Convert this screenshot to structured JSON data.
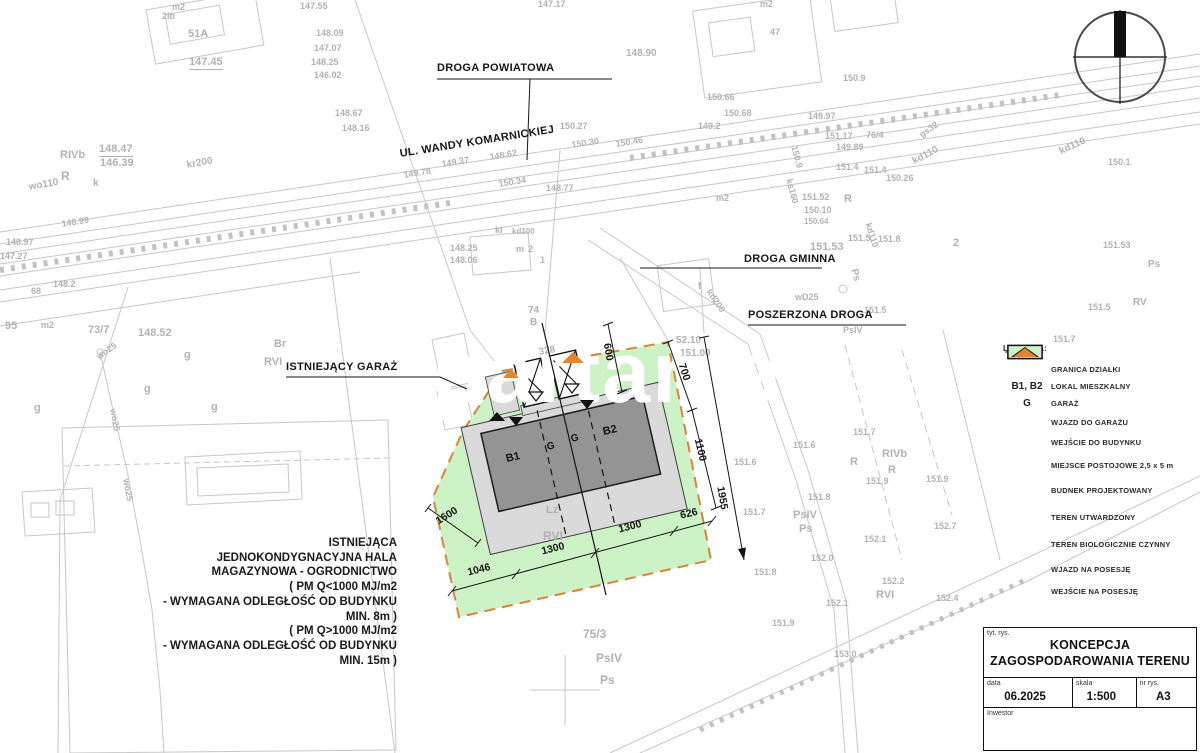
{
  "watermark": "apartame",
  "colors": {
    "green": "#cdf2c5",
    "dark": "#949494",
    "light": "#dadada",
    "orange": "#e2862e",
    "boundary": "#d9833b"
  },
  "callouts": {
    "droga_powiatowa": "DROGA POWIATOWA",
    "ul_wandy": "UL. WANDY KOMARNICKIEJ",
    "droga_gminna": "DROGA GMINNA",
    "poszerzona_droga": "POSZERZONA DROGA",
    "istniejacy_garaz": "ISTNIEJĄCY GARAŻ"
  },
  "note": {
    "lines": [
      "ISTNIEJĄCA",
      "JEDNOKONDYGNACYJNA HALA",
      "MAGAZYNOWA - OGRODNICTWO",
      "( PM Q<1000 MJ/m2",
      "- WYMAGANA ODLEGŁOŚĆ OD BUDYNKU",
      "MIN. 8m )",
      "( PM Q>1000 MJ/m2",
      "- WYMAGANA ODLEGŁOŚĆ OD BUDYNKU",
      "MIN. 15m )"
    ]
  },
  "dims": [
    {
      "t": "600",
      "x": 608,
      "y": 352,
      "r": 80
    },
    {
      "t": "700",
      "x": 684,
      "y": 372,
      "r": 72
    },
    {
      "t": "1100",
      "x": 700,
      "y": 450,
      "r": 77
    },
    {
      "t": "1955",
      "x": 722,
      "y": 498,
      "r": 80
    },
    {
      "t": "1600",
      "x": 447,
      "y": 516,
      "r": -32
    },
    {
      "t": "1046",
      "x": 479,
      "y": 570,
      "r": -14
    },
    {
      "t": "1300",
      "x": 553,
      "y": 549,
      "r": -14
    },
    {
      "t": "1300",
      "x": 630,
      "y": 527,
      "r": -14
    },
    {
      "t": "626",
      "x": 689,
      "y": 514,
      "r": -14
    }
  ],
  "building_labels": [
    {
      "t": "B1",
      "x": 513,
      "y": 458,
      "r": -13,
      "fs": 11
    },
    {
      "t": "G",
      "x": 551,
      "y": 447,
      "r": -13,
      "fs": 10
    },
    {
      "t": "G",
      "x": 575,
      "y": 439,
      "r": -13,
      "fs": 10
    },
    {
      "t": "B2",
      "x": 610,
      "y": 431,
      "r": -13,
      "fs": 11
    }
  ],
  "map_text": [
    [
      300,
      2,
      "147.55"
    ],
    [
      316,
      29,
      "148.09"
    ],
    [
      314,
      44,
      "147.07"
    ],
    [
      311,
      58,
      "148.25"
    ],
    [
      314,
      71,
      "146.02"
    ],
    [
      335,
      109,
      "148.67"
    ],
    [
      342,
      124,
      "148.16"
    ],
    [
      172,
      3,
      "m2"
    ],
    [
      162,
      12,
      "2lb"
    ],
    [
      188,
      29,
      "51A",
      0,
      11
    ],
    [
      189,
      57,
      "147.45",
      0,
      11,
      1
    ],
    [
      538,
      0,
      "147.17"
    ],
    [
      626,
      49,
      "148.90",
      0,
      10
    ],
    [
      60,
      150,
      "RIVb",
      0,
      11
    ],
    [
      99,
      144,
      "148.47",
      0,
      11,
      1
    ],
    [
      100,
      158,
      "146.39",
      0,
      11
    ],
    [
      61,
      170,
      "R",
      0,
      12
    ],
    [
      93,
      179,
      "k",
      0,
      10
    ],
    [
      28,
      183,
      "wo110",
      -10,
      10
    ],
    [
      186,
      161,
      "kr200",
      -10,
      10
    ],
    [
      403,
      171,
      "149.78",
      -9
    ],
    [
      441,
      160,
      "149.37",
      -9
    ],
    [
      489,
      153,
      "148.62",
      -9
    ],
    [
      498,
      180,
      "150.34",
      -9
    ],
    [
      546,
      184,
      "148.77"
    ],
    [
      560,
      122,
      "150.27"
    ],
    [
      571,
      141,
      "150.30",
      -9
    ],
    [
      615,
      140,
      "150.46",
      -9
    ],
    [
      495,
      226,
      "kl"
    ],
    [
      512,
      228,
      "kd100",
      0,
      8
    ],
    [
      516,
      245,
      "m"
    ],
    [
      528,
      245,
      "2"
    ],
    [
      540,
      256,
      "1"
    ],
    [
      450,
      244,
      "148.25"
    ],
    [
      450,
      256,
      "148.06"
    ],
    [
      528,
      306,
      "74",
      0,
      10
    ],
    [
      530,
      318,
      "B",
      0,
      10
    ],
    [
      716,
      194,
      "m2"
    ],
    [
      770,
      28,
      "47"
    ],
    [
      760,
      0,
      "m2"
    ],
    [
      843,
      74,
      "150.9"
    ],
    [
      707,
      93,
      "150.66"
    ],
    [
      724,
      109,
      "150.68"
    ],
    [
      698,
      122,
      "149.2"
    ],
    [
      808,
      112,
      "149.97"
    ],
    [
      825,
      132,
      "151.17"
    ],
    [
      866,
      131,
      "76/4"
    ],
    [
      836,
      143,
      "149.89"
    ],
    [
      798,
      145,
      "150.9",
      75
    ],
    [
      836,
      163,
      "151.4"
    ],
    [
      864,
      166,
      "151.4"
    ],
    [
      886,
      174,
      "150.26"
    ],
    [
      911,
      158,
      "kd110",
      -28,
      10
    ],
    [
      918,
      132,
      "gs32",
      -35
    ],
    [
      872,
      222,
      "kd110",
      72
    ],
    [
      793,
      178,
      "ks160",
      75
    ],
    [
      802,
      193,
      "151.52"
    ],
    [
      844,
      194,
      "R",
      0,
      11
    ],
    [
      804,
      206,
      "150.10"
    ],
    [
      804,
      218,
      "150.64",
      0,
      8
    ],
    [
      848,
      234,
      "151.5"
    ],
    [
      810,
      242,
      "151.53",
      0,
      11
    ],
    [
      878,
      235,
      "151.8"
    ],
    [
      953,
      238,
      "2",
      0,
      11
    ],
    [
      858,
      268,
      "Ps",
      75,
      10
    ],
    [
      795,
      293,
      "wD25",
      0,
      9
    ],
    [
      843,
      326,
      "PsIV"
    ],
    [
      864,
      306,
      "151.5"
    ],
    [
      698,
      281,
      "t",
      0,
      11
    ],
    [
      712,
      288,
      "kd200",
      55,
      9
    ],
    [
      88,
      325,
      "73/7",
      0,
      11
    ],
    [
      274,
      339,
      "Br",
      0,
      11
    ],
    [
      264,
      357,
      "RVI",
      0,
      11
    ],
    [
      41,
      321,
      "m2"
    ],
    [
      138,
      328,
      "148.52",
      0,
      11
    ],
    [
      5,
      321,
      "95",
      0,
      11
    ],
    [
      184,
      350,
      "g",
      0,
      11
    ],
    [
      144,
      384,
      "g",
      0,
      11
    ],
    [
      211,
      402,
      "g",
      0,
      11
    ],
    [
      34,
      403,
      "g",
      0,
      11
    ],
    [
      95,
      354,
      "wo25",
      -35,
      9
    ],
    [
      117,
      408,
      "wo25",
      80,
      9
    ],
    [
      130,
      478,
      "wo25",
      80,
      9
    ],
    [
      61,
      220,
      "148.99",
      -9
    ],
    [
      6,
      238,
      "148.97"
    ],
    [
      0,
      252,
      "147.27"
    ],
    [
      53,
      280,
      "148.2"
    ],
    [
      31,
      287,
      "68"
    ],
    [
      538,
      348,
      "328",
      -10,
      10
    ],
    [
      676,
      336,
      "52.10",
      0,
      10
    ],
    [
      680,
      349,
      "151.00",
      0,
      10
    ],
    [
      546,
      505,
      "Lz",
      0,
      11
    ],
    [
      543,
      530,
      "RVI",
      0,
      12
    ],
    [
      583,
      628,
      "75/3",
      0,
      12
    ],
    [
      596,
      652,
      "PsIV",
      0,
      12
    ],
    [
      600,
      674,
      "Ps",
      0,
      12
    ],
    [
      793,
      441,
      "151.6"
    ],
    [
      853,
      428,
      "151.7"
    ],
    [
      734,
      458,
      "151.6"
    ],
    [
      808,
      493,
      "151.8"
    ],
    [
      793,
      510,
      "PsIV",
      0,
      11
    ],
    [
      799,
      524,
      "Ps",
      0,
      11
    ],
    [
      743,
      508,
      "151.7"
    ],
    [
      850,
      457,
      "R",
      0,
      11
    ],
    [
      882,
      449,
      "RIVb",
      0,
      11
    ],
    [
      888,
      465,
      "R",
      0,
      11
    ],
    [
      866,
      477,
      "151.9"
    ],
    [
      926,
      475,
      "151.9"
    ],
    [
      864,
      535,
      "152.1"
    ],
    [
      811,
      554,
      "152.0"
    ],
    [
      882,
      577,
      "152.2"
    ],
    [
      876,
      590,
      "RVI",
      0,
      11
    ],
    [
      754,
      568,
      "151.8"
    ],
    [
      826,
      599,
      "152.1"
    ],
    [
      772,
      619,
      "151.9"
    ],
    [
      934,
      522,
      "152.7"
    ],
    [
      936,
      594,
      "152.4"
    ],
    [
      834,
      650,
      "153.0"
    ],
    [
      1058,
      148,
      "kd110",
      -25,
      10
    ],
    [
      1108,
      158,
      "150.1"
    ],
    [
      1103,
      241,
      "151.53"
    ],
    [
      1148,
      260,
      "Ps",
      0,
      10
    ],
    [
      1088,
      303,
      "151.5"
    ],
    [
      1133,
      298,
      "RV",
      0,
      10
    ],
    [
      1053,
      335,
      "151.7"
    ]
  ],
  "legend": {
    "title": "LEGENDA:",
    "items": [
      {
        "sym": "dash-orange",
        "label": "GRANICA DZIAŁKI",
        "h": 18
      },
      {
        "sym": "text",
        "symtext": "B1, B2",
        "label": "LOKAL MIESZKALNY",
        "h": 17
      },
      {
        "sym": "text",
        "symtext": "G",
        "label": "GARAŻ",
        "h": 17
      },
      {
        "sym": "tri-down-white",
        "label": "WJAZD DO GARAŻU",
        "h": 20
      },
      {
        "sym": "tri-down-black",
        "label": "WEJŚCIE DO BUDYNKU",
        "h": 21
      },
      {
        "sym": "xbox",
        "label": "MIEJSCE POSTOJOWE 2,5 x 5 m",
        "h": 24
      },
      {
        "sym": "rect-dark",
        "label": "BUDNEK PROJEKTOWANY",
        "h": 27
      },
      {
        "sym": "rect-light",
        "label": "TEREN UTWARDZONY",
        "h": 27
      },
      {
        "sym": "rect-green",
        "label": "TEREN BIOLOGICZNIE CZYNNY",
        "h": 27
      },
      {
        "sym": "tri-up-black",
        "label": "WJAZD NA POSESJĘ",
        "h": 22
      },
      {
        "sym": "tri-up-orange",
        "label": "WEJŚCIE NA POSESJĘ",
        "h": 22
      }
    ]
  },
  "titleblock": {
    "tyt_label": "tyt. rys.",
    "title_line1": "KONCEPCJA",
    "title_line2": "ZAGOSPODAROWANIA TERENU",
    "data_label": "data",
    "data_value": "06.2025",
    "skala_label": "skala",
    "skala_value": "1:500",
    "nr_label": "nr rys.",
    "nr_value": "A3",
    "inwestor_label": "Inwestor"
  }
}
